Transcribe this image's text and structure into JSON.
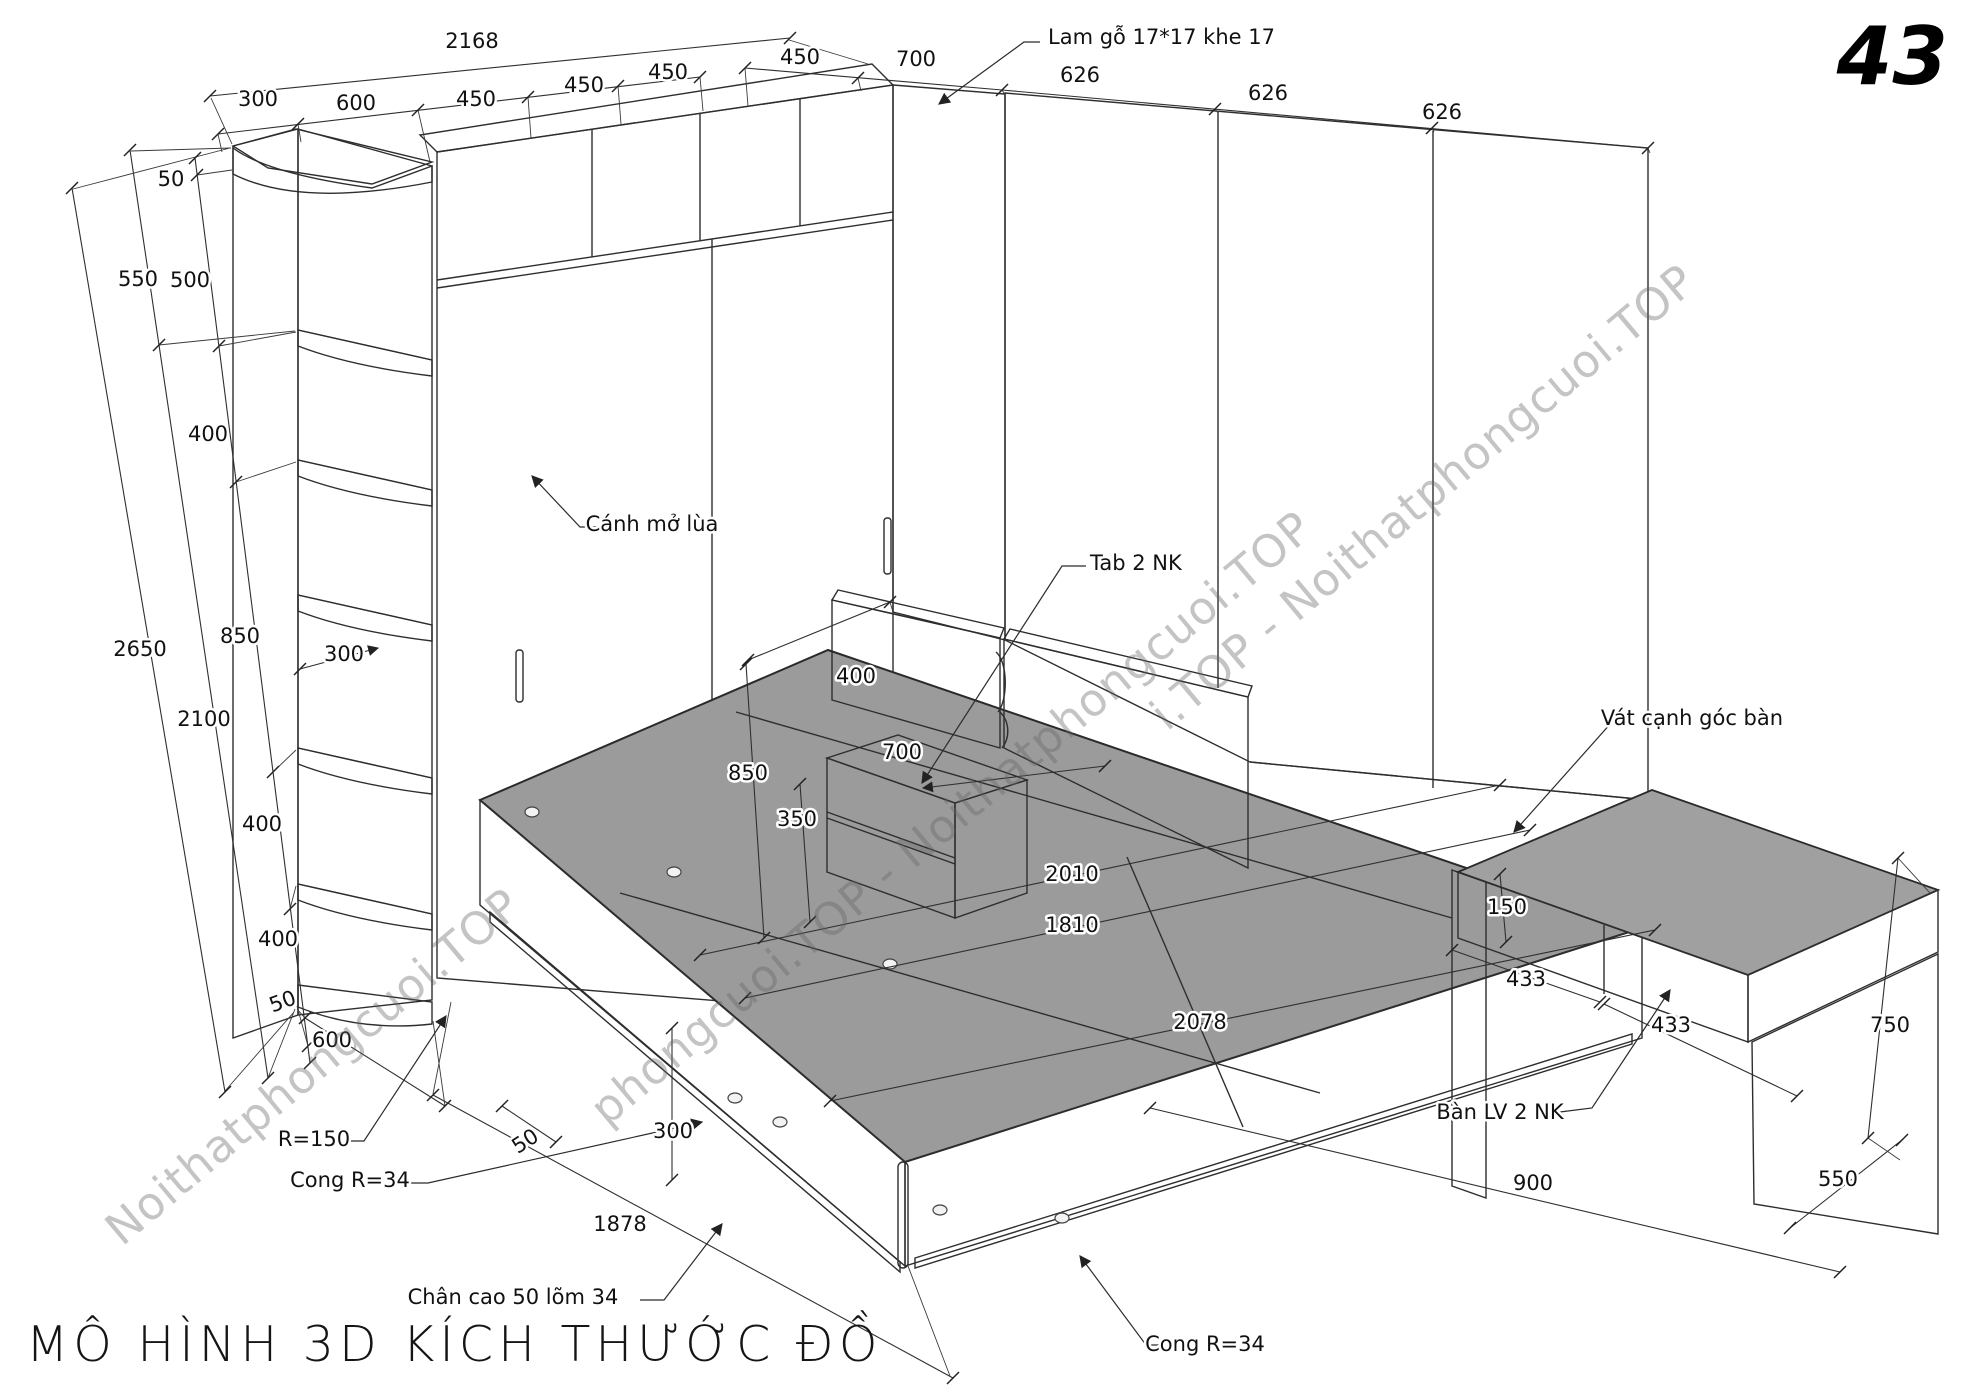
{
  "page": {
    "number": "43",
    "title": "MÔ HÌNH 3D KÍCH THƯỚC ĐỒ"
  },
  "watermark": {
    "text": "Noithatphongcuoi.TOP",
    "bands": [
      "Noithatphongcuoi.TOP",
      "phongcuoi.TOP - Noithatphongcuoi.TOP",
      "i.TOP - Noithatphongcuoi.TOP"
    ]
  },
  "drawing": {
    "labels": [
      {
        "id": "dim-2168",
        "text": "2168",
        "x": 472,
        "y": 48
      },
      {
        "id": "dim-300-top",
        "text": "300",
        "x": 258,
        "y": 106
      },
      {
        "id": "dim-600-top",
        "text": "600",
        "x": 356,
        "y": 110
      },
      {
        "id": "dim-450-1",
        "text": "450",
        "x": 476,
        "y": 106
      },
      {
        "id": "dim-450-2",
        "text": "450",
        "x": 584,
        "y": 92
      },
      {
        "id": "dim-450-3",
        "text": "450",
        "x": 668,
        "y": 79
      },
      {
        "id": "dim-450-4",
        "text": "450",
        "x": 800,
        "y": 64
      },
      {
        "id": "dim-700-top",
        "text": "700",
        "x": 916,
        "y": 66
      },
      {
        "id": "dim-626-1",
        "text": "626",
        "x": 1080,
        "y": 82
      },
      {
        "id": "dim-626-2",
        "text": "626",
        "x": 1268,
        "y": 100
      },
      {
        "id": "dim-626-3",
        "text": "626",
        "x": 1442,
        "y": 119
      },
      {
        "id": "callout-lam-go",
        "text": "Lam gỗ 17*17 khe 17",
        "x": 1048,
        "y": 44,
        "anchor": "start"
      },
      {
        "id": "dim-50-top",
        "text": "50",
        "x": 171,
        "y": 186
      },
      {
        "id": "dim-550",
        "text": "550",
        "x": 138,
        "y": 286
      },
      {
        "id": "dim-500",
        "text": "500",
        "x": 190,
        "y": 287
      },
      {
        "id": "dim-400-1",
        "text": "400",
        "x": 208,
        "y": 441
      },
      {
        "id": "dim-2650",
        "text": "2650",
        "x": 140,
        "y": 656
      },
      {
        "id": "dim-850-left",
        "text": "850",
        "x": 240,
        "y": 643
      },
      {
        "id": "dim-2100",
        "text": "2100",
        "x": 204,
        "y": 726
      },
      {
        "id": "dim-300-shelf",
        "text": "300",
        "x": 344,
        "y": 661
      },
      {
        "id": "callout-canh-mo-lua",
        "text": "Cánh mở lùa",
        "x": 652,
        "y": 531
      },
      {
        "id": "dim-400-2",
        "text": "400",
        "x": 262,
        "y": 831
      },
      {
        "id": "dim-400-3",
        "text": "400",
        "x": 278,
        "y": 946
      },
      {
        "id": "dim-50-left-bottom",
        "text": "50",
        "x": 285,
        "y": 1008,
        "rot": -20
      },
      {
        "id": "dim-600-bottom",
        "text": "600",
        "x": 332,
        "y": 1047
      },
      {
        "id": "callout-r150",
        "text": "R=150",
        "x": 314,
        "y": 1146
      },
      {
        "id": "callout-cong-r34-left",
        "text": "Cong R=34",
        "x": 350,
        "y": 1187
      },
      {
        "id": "dim-400-tab",
        "text": "400",
        "x": 856,
        "y": 683
      },
      {
        "id": "dim-700-tab",
        "text": "700",
        "x": 902,
        "y": 759
      },
      {
        "id": "dim-850-tab",
        "text": "850",
        "x": 748,
        "y": 780
      },
      {
        "id": "dim-350-tab",
        "text": "350",
        "x": 797,
        "y": 826
      },
      {
        "id": "callout-tab-2nk",
        "text": "Tab 2 NK",
        "x": 1090,
        "y": 570,
        "anchor": "start"
      },
      {
        "id": "dim-2010",
        "text": "2010",
        "x": 1072,
        "y": 881
      },
      {
        "id": "dim-1810",
        "text": "1810",
        "x": 1072,
        "y": 932
      },
      {
        "id": "dim-2078",
        "text": "2078",
        "x": 1200,
        "y": 1029
      },
      {
        "id": "dim-300-bed",
        "text": "300",
        "x": 673,
        "y": 1138
      },
      {
        "id": "dim-50-bed",
        "text": "50",
        "x": 529,
        "y": 1147,
        "rot": -33
      },
      {
        "id": "dim-1878",
        "text": "1878",
        "x": 620,
        "y": 1231
      },
      {
        "id": "callout-chan-cao",
        "text": "Chân cao 50 lõm 34",
        "x": 513,
        "y": 1304
      },
      {
        "id": "callout-cong-r34-bottom",
        "text": "Cong R=34",
        "x": 1205,
        "y": 1351
      },
      {
        "id": "callout-vat-canh",
        "text": "Vát cạnh góc bàn",
        "x": 1692,
        "y": 725
      },
      {
        "id": "dim-150-desk",
        "text": "150",
        "x": 1507,
        "y": 914
      },
      {
        "id": "dim-433-1",
        "text": "433",
        "x": 1526,
        "y": 986
      },
      {
        "id": "dim-433-2",
        "text": "433",
        "x": 1671,
        "y": 1032
      },
      {
        "id": "callout-ban-lv",
        "text": "Bàn LV 2 NK",
        "x": 1500,
        "y": 1119
      },
      {
        "id": "dim-900",
        "text": "900",
        "x": 1533,
        "y": 1190
      },
      {
        "id": "dim-750",
        "text": "750",
        "x": 1890,
        "y": 1032
      },
      {
        "id": "dim-550-desk",
        "text": "550",
        "x": 1838,
        "y": 1186
      }
    ]
  }
}
